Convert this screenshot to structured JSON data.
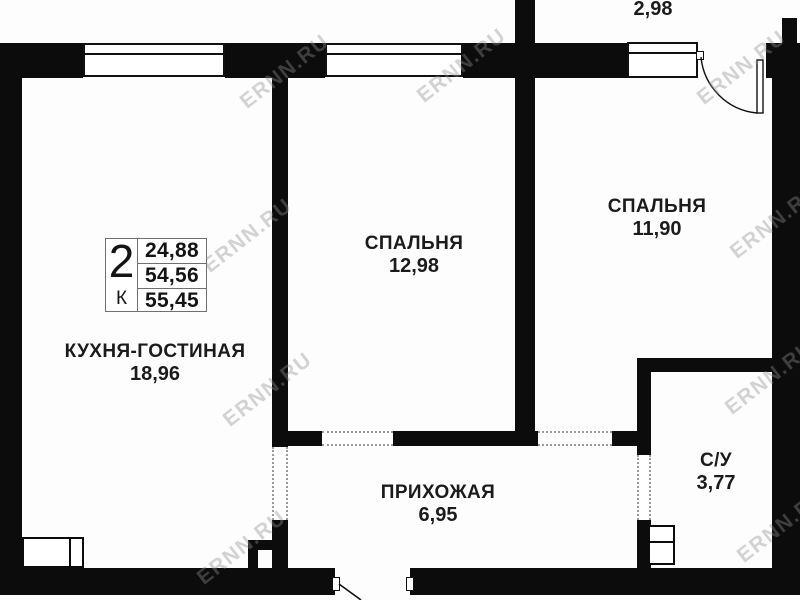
{
  "plan": {
    "watermark_text": "ERNN.RU",
    "info_box": {
      "rooms_count": "2",
      "class_letter": "К",
      "row1": "24,88",
      "row2": "54,56",
      "row3": "55,45"
    },
    "rooms": [
      {
        "id": "kitchen-living",
        "name": "КУХНЯ-ГОСТИНАЯ",
        "area": "18,96"
      },
      {
        "id": "bedroom-1",
        "name": "СПАЛЬНЯ",
        "area": "12,98"
      },
      {
        "id": "bedroom-2",
        "name": "СПАЛЬНЯ",
        "area": "11,90"
      },
      {
        "id": "hallway",
        "name": "ПРИХОЖАЯ",
        "area": "6,95"
      },
      {
        "id": "bathroom",
        "name": "С/У",
        "area": "3,77"
      },
      {
        "id": "balcony",
        "name": "",
        "area": "2,98"
      }
    ]
  }
}
